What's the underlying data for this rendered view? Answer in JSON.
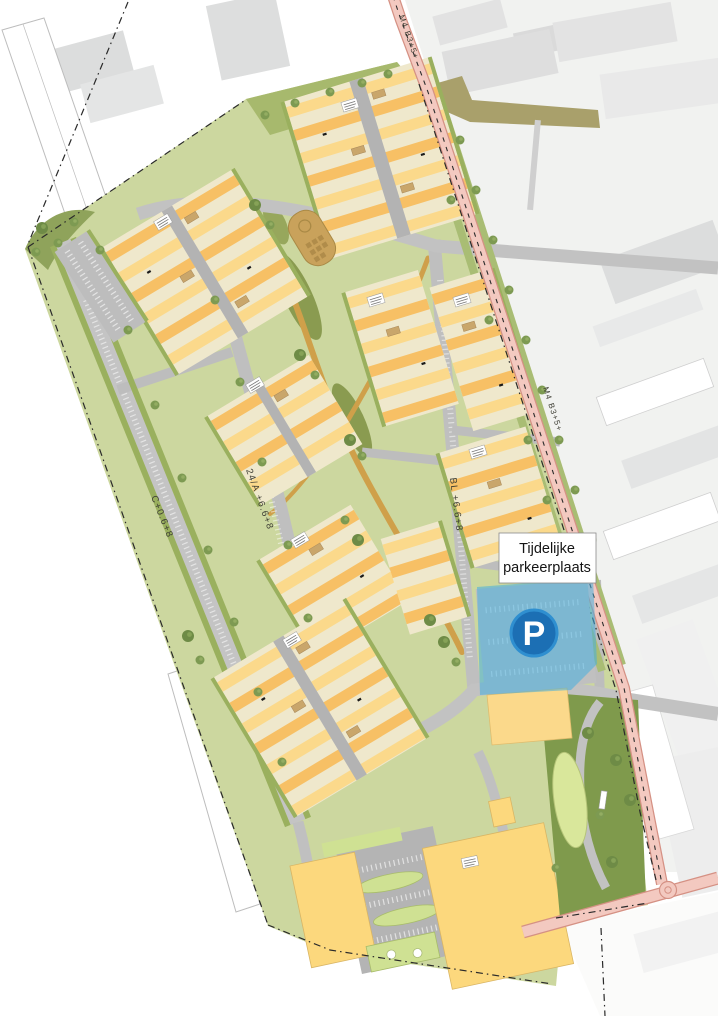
{
  "map": {
    "annotation_box": {
      "line1": "Tijdelijke",
      "line2": "parkeerplaats"
    },
    "parking_badge": {
      "letter": "P"
    },
    "road_codes": {
      "top_main": "M4 B3+5+",
      "mid_main": "M4 B3+5+",
      "bl_street": "BL +6.6+8",
      "c_street": "C+0.6+8",
      "street_24a": "24/A +6.6+8"
    },
    "colors": {
      "site_green": "#ccd79f",
      "dark_green": "#7f9a4c",
      "hedge_olive": "#9ab05e",
      "housing_yellow": "#fbd98b",
      "housing_orange": "#f7c065",
      "yard_cream": "#efe8cc",
      "road_gray": "#c2c2c2",
      "main_road_pink": "#f3c9c0",
      "path_tan": "#cfa04a",
      "parking_highlight_blue": "#45aede",
      "parking_badge_blue": "#1c6fb4",
      "context_gray": "#e0e1e1"
    }
  }
}
